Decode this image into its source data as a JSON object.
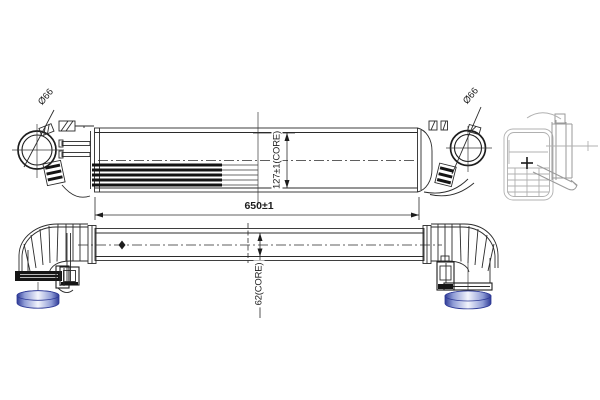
{
  "drawing_type": "intercooler-technical-drawing",
  "dimensions": {
    "left_port_diameter": "Ø66",
    "right_port_diameter": "Ø66",
    "core_height": "127±1(CORE)",
    "overall_length": "650±1",
    "core_depth": "62(CORE)"
  },
  "colors": {
    "line": "#2b2b2b",
    "side_view_line": "#b0b0b0",
    "port_blue_dark": "#2e3a96",
    "port_blue_mid": "#8f9cd6",
    "port_blue_light": "#f2f4fc",
    "background": "#ffffff"
  }
}
